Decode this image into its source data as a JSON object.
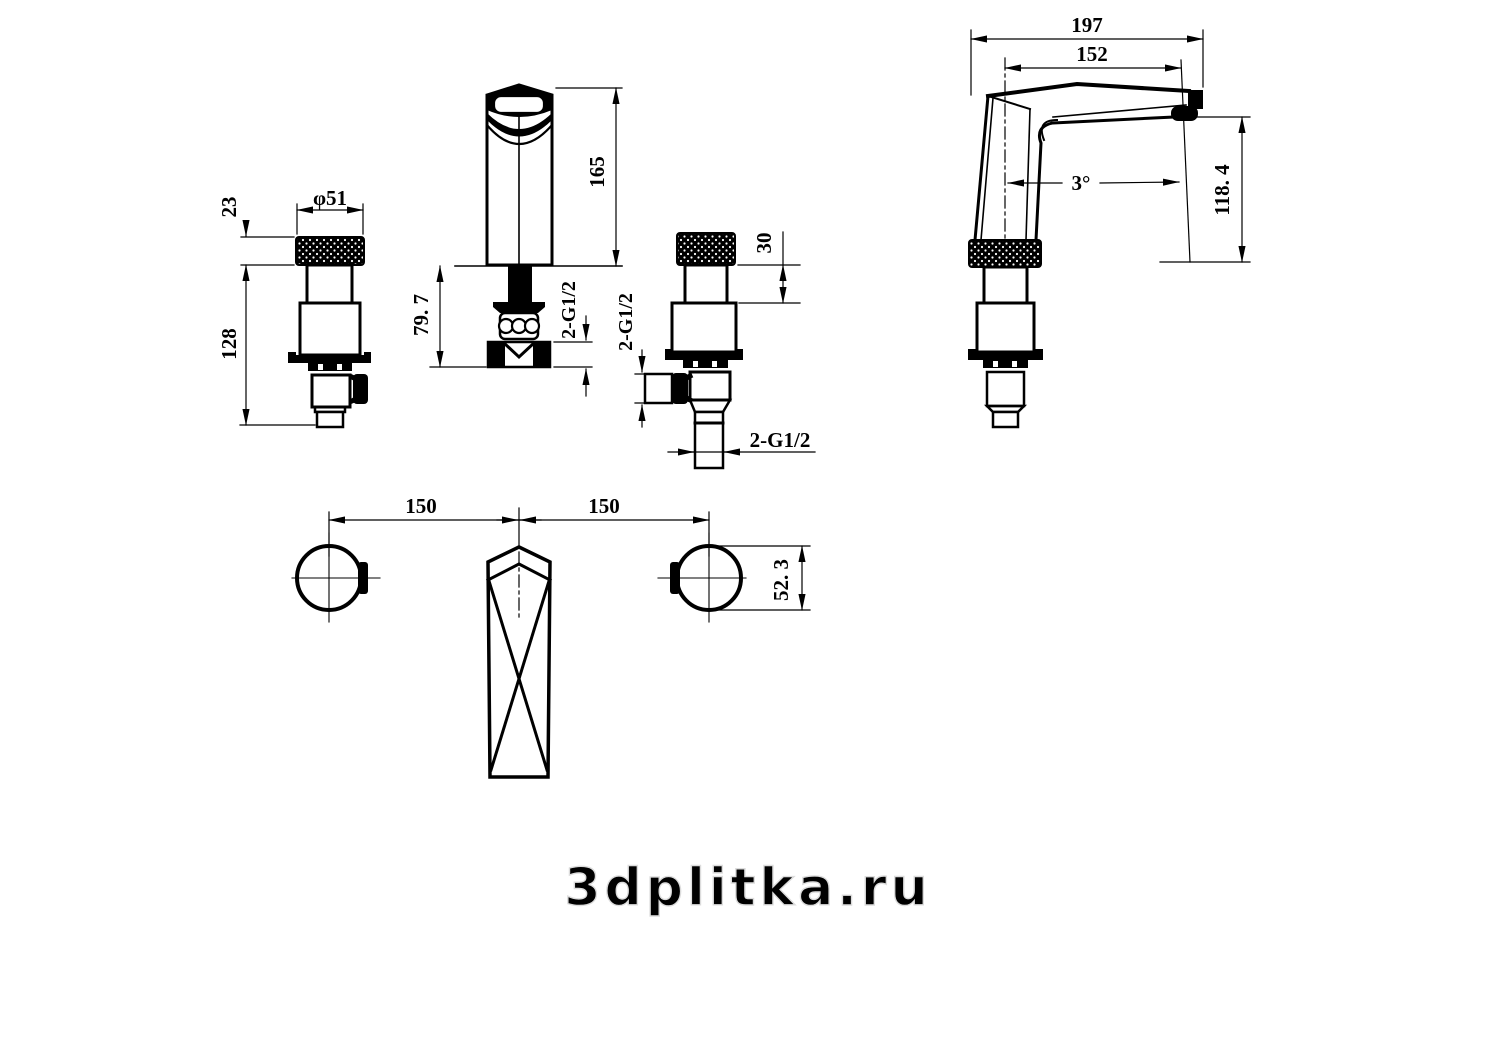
{
  "watermark": {
    "text": "3dplitka.ru",
    "color": "#dcdcdc"
  },
  "colors": {
    "line": "#000000",
    "background": "#ffffff"
  },
  "views": {
    "handle_front": {
      "dims": {
        "knurl_height": "23",
        "overall_height": "128",
        "knob_diameter": "φ51"
      }
    },
    "spout_front": {
      "dims": {
        "height_above_deck": "165",
        "under_deck_length": "79. 7",
        "thread": "2-G1/2"
      }
    },
    "handle_side": {
      "dims": {
        "neck_height": "30",
        "side_outlet_thread": "2-G1/2",
        "bottom_thread": "2-G1/2"
      }
    },
    "spout_side": {
      "dims": {
        "overall_length": "197",
        "spout_reach": "152",
        "spout_angle": "3°",
        "outlet_height": "118. 4"
      }
    },
    "plan": {
      "dims": {
        "pitch_left": "150",
        "pitch_right": "150",
        "handle_diameter": "52. 3"
      }
    }
  }
}
